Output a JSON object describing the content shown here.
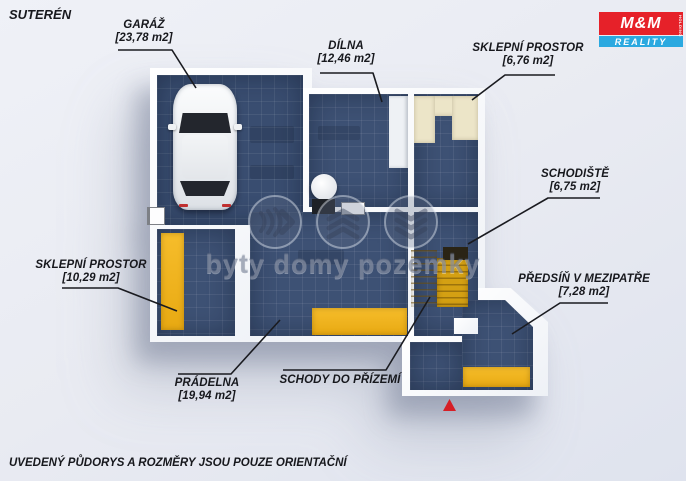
{
  "title": "SUTERÉN",
  "disclaimer": "UVEDENÝ PŮDORYS A ROZMĚRY JSOU POUZE ORIENTAČNÍ",
  "watermark": {
    "text": "byty domy pozemky"
  },
  "logo": {
    "top": "M&M",
    "bottom": "REALITY",
    "side": "HOLDING"
  },
  "labels": {
    "garaz": {
      "name": "GARÁŽ",
      "area": "[23,78 m2]"
    },
    "dilna": {
      "name": "DÍLNA",
      "area": "[12,46 m2]"
    },
    "sklep_top": {
      "name": "SKLEPNÍ PROSTOR",
      "area": "[6,76 m2]"
    },
    "schodiste": {
      "name": "SCHODIŠTĚ",
      "area": "[6,75 m2]"
    },
    "sklep_left": {
      "name": "SKLEPNÍ PROSTOR",
      "area": "[10,29 m2]"
    },
    "predsin": {
      "name": "PŘEDSÍŇ V MEZIPATŘE",
      "area": "[7,28 m2]"
    },
    "pradelna": {
      "name": "PRÁDELNA",
      "area": "[19,94 m2]"
    },
    "schody": {
      "name": "SCHODY DO PŘÍZEMÍ"
    }
  },
  "colors": {
    "background": "#e9ebf2",
    "floor_blue": "#3d5174",
    "wall_white": "#f8fafc",
    "accent_yellow": "#efb11e",
    "cabinet_cream": "#ece5c8",
    "logo_red": "#e62129",
    "logo_blue": "#2ba9e0",
    "marker_red": "#d61f26",
    "label_text": "#17181d"
  }
}
